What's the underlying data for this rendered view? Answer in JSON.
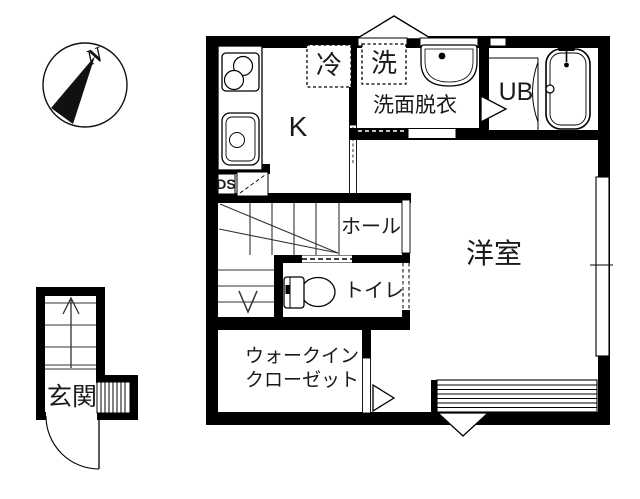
{
  "floorplan": {
    "compass": {
      "north_label": "N"
    },
    "rooms": {
      "kitchen": "K",
      "refrigerator": "冷",
      "washer": "洗",
      "washroom": "洗面脱衣",
      "unit_bath": "UB",
      "duct_space": "DS",
      "hall": "ホール",
      "toilet": "トイレ",
      "western_room": "洋室",
      "walk_in_closet_line1": "ウォークイン",
      "walk_in_closet_line2": "クローゼット",
      "entrance": "玄関"
    },
    "colors": {
      "wall": "#000000",
      "background": "#ffffff",
      "line": "#1a1a1a"
    }
  }
}
